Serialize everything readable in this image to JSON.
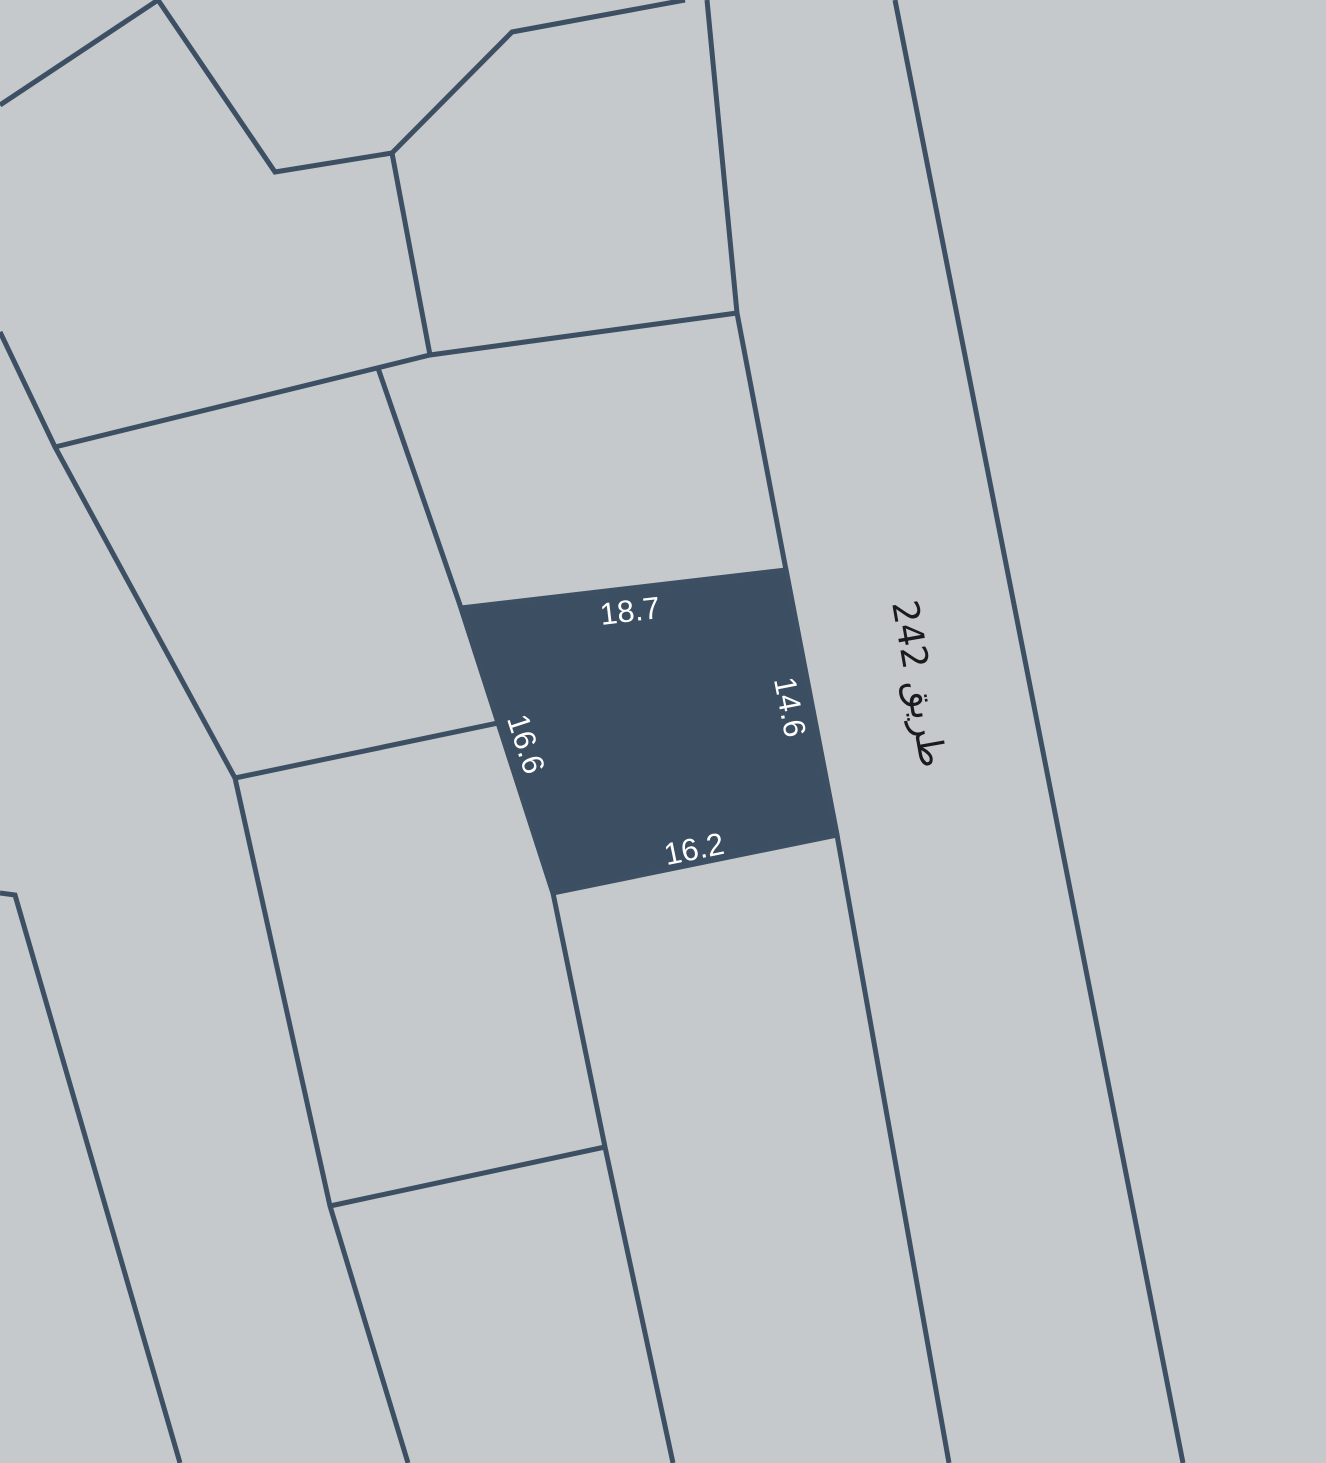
{
  "map": {
    "background_color": "#c5c9cc",
    "boundary_color": "#3d4f63",
    "selected_parcel": {
      "fill_color": "#3c4e61",
      "label_color": "#ffffff",
      "dimensions": {
        "top": "18.7",
        "right": "14.6",
        "left": "16.6",
        "bottom": "16.2"
      }
    },
    "road": {
      "label": "طريق 242",
      "label_color": "#1b1b1b"
    }
  }
}
